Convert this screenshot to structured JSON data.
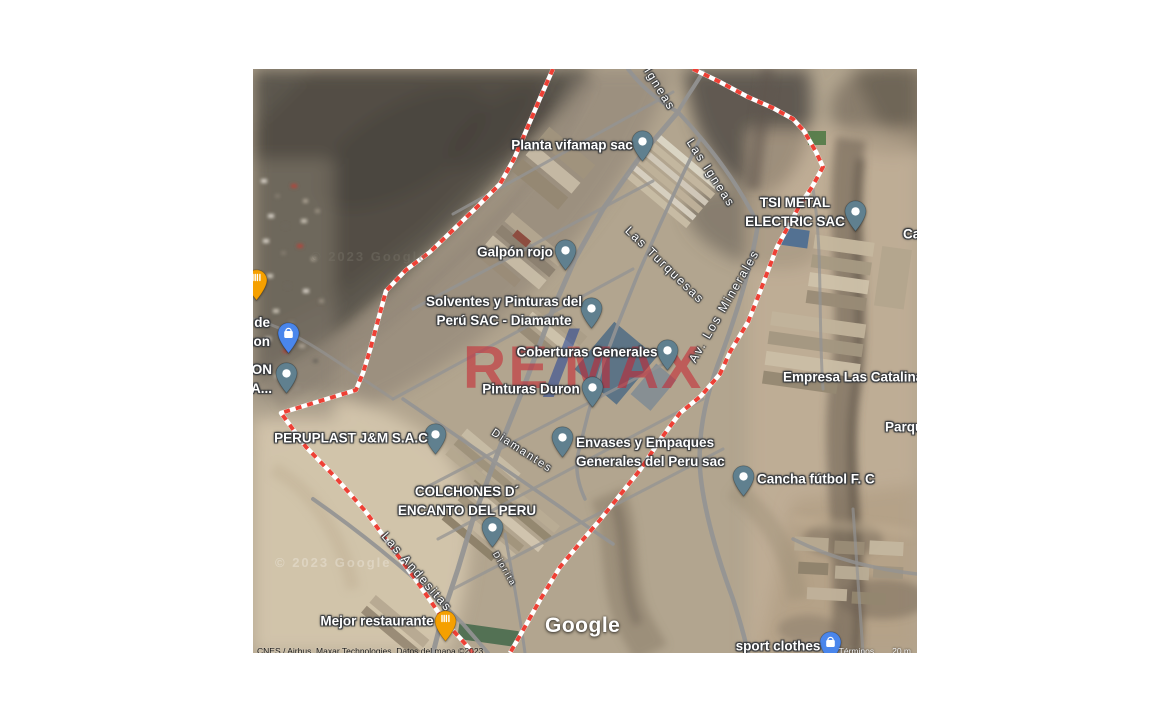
{
  "map": {
    "left": 253,
    "top": 69,
    "width": 664,
    "height": 584
  },
  "branding": {
    "google_logo": "Google",
    "watermark": {
      "re": "RE",
      "slash": "/",
      "max": "MAX",
      "red": "#C8222E",
      "blue": "#1F4096"
    },
    "ghost_credit": "© 2023 Google"
  },
  "attribution": {
    "imagery": "CNES / Airbus, Maxar Technologies, Datos del mapa ©2023",
    "terms": "Términos",
    "scale": "20 m"
  },
  "colors": {
    "pin_poi": "#60808F",
    "pin_shop": "#4A86EC",
    "pin_food": "#F5A000",
    "boundary_red": "#EE4035",
    "road": "#949494",
    "label_text": "#FFFFFF"
  },
  "labels": [
    {
      "name": "label-planta-vifamap",
      "lines": [
        "Planta vifamap sac"
      ],
      "x": 319,
      "y": 76,
      "align": "center"
    },
    {
      "name": "label-galpon-rojo",
      "lines": [
        "Galpón rojo"
      ],
      "x": 262,
      "y": 183,
      "align": "center"
    },
    {
      "name": "label-solventes-pinturas",
      "lines": [
        "Solventes y Pinturas del",
        "Perú SAC - Diamante"
      ],
      "x": 251,
      "y": 242,
      "align": "center"
    },
    {
      "name": "label-coberturas-generales",
      "lines": [
        "Coberturas Generales"
      ],
      "x": 334,
      "y": 283,
      "align": "center"
    },
    {
      "name": "label-pinturas-duron",
      "lines": [
        "Pinturas Duron"
      ],
      "x": 278,
      "y": 320,
      "align": "center"
    },
    {
      "name": "label-tsi-metal-electric",
      "lines": [
        "TSI METAL",
        "ELECTRIC SAC"
      ],
      "x": 542,
      "y": 143,
      "align": "center"
    },
    {
      "name": "label-empresa-las-catalina",
      "lines": [
        "Empresa Las Catalina"
      ],
      "x": 530,
      "y": 308,
      "align": "left"
    },
    {
      "name": "label-parque",
      "lines": [
        "Parqu"
      ],
      "x": 632,
      "y": 358,
      "align": "left"
    },
    {
      "name": "label-cancha-futbol",
      "lines": [
        "Cancha fútbol F. C"
      ],
      "x": 504,
      "y": 410,
      "align": "left"
    },
    {
      "name": "label-peruplast",
      "lines": [
        "PERUPLAST J&M S.A.C"
      ],
      "x": 98,
      "y": 369,
      "align": "center"
    },
    {
      "name": "label-envases-empaques",
      "lines": [
        "Envases y Empaques",
        "Generales del Peru sac"
      ],
      "x": 323,
      "y": 383,
      "align": "left"
    },
    {
      "name": "label-colchones-encanto",
      "lines": [
        "COLCHONES D´",
        "ENCANTO DEL PERU"
      ],
      "x": 214,
      "y": 432,
      "align": "center"
    },
    {
      "name": "label-mejor-restaurante",
      "lines": [
        "Mejor restaurante"
      ],
      "x": 124,
      "y": 552,
      "align": "center"
    },
    {
      "name": "label-sport-clothes",
      "lines": [
        "sport clothes"
      ],
      "x": 525,
      "y": 577,
      "align": "center"
    },
    {
      "name": "label-fragment-r-de",
      "lines": [
        "r de",
        "son"
      ],
      "x": 17,
      "y": 263,
      "align": "right"
    },
    {
      "name": "label-fragment-ion-da",
      "lines": [
        "ION",
        "DA..."
      ],
      "x": 19,
      "y": 310,
      "align": "right"
    },
    {
      "name": "label-fragment-ca",
      "lines": [
        "Ca"
      ],
      "x": 650,
      "y": 165,
      "align": "left"
    }
  ],
  "streets": [
    {
      "name": "street-las-igneas-top",
      "label": "Igneas",
      "x": 407,
      "y": 20,
      "angle": 58,
      "size": 12
    },
    {
      "name": "street-las-igneas",
      "label": "Las Igneas",
      "x": 458,
      "y": 104,
      "angle": 57,
      "size": 12
    },
    {
      "name": "street-las-turquesas",
      "label": "Las Turquesas",
      "x": 412,
      "y": 196,
      "angle": 44,
      "size": 12
    },
    {
      "name": "street-av-los-minerales",
      "label": "Av. Los Minerales",
      "x": 471,
      "y": 237,
      "angle": -60,
      "size": 12
    },
    {
      "name": "street-diamantes",
      "label": "Diamantes",
      "x": 269,
      "y": 382,
      "angle": 33,
      "size": 11
    },
    {
      "name": "street-las-andesitas",
      "label": "Las Andesitas",
      "x": 164,
      "y": 503,
      "angle": 49,
      "size": 12
    },
    {
      "name": "street-diorita",
      "label": "Diorita",
      "x": 252,
      "y": 500,
      "angle": 60,
      "size": 8.5
    }
  ],
  "pins": [
    {
      "name": "pin-planta-vifamap",
      "type": "poi",
      "x": 389,
      "y": 72
    },
    {
      "name": "pin-galpon-rojo",
      "type": "poi",
      "x": 312,
      "y": 181
    },
    {
      "name": "pin-solventes",
      "type": "poi",
      "x": 338,
      "y": 239
    },
    {
      "name": "pin-coberturas",
      "type": "poi",
      "x": 414,
      "y": 281
    },
    {
      "name": "pin-pinturas-duron",
      "type": "poi",
      "x": 339,
      "y": 318
    },
    {
      "name": "pin-tsi-metal",
      "type": "poi",
      "x": 602,
      "y": 142
    },
    {
      "name": "pin-peruplast",
      "type": "poi",
      "x": 182,
      "y": 365
    },
    {
      "name": "pin-envases",
      "type": "poi",
      "x": 309,
      "y": 368
    },
    {
      "name": "pin-colchones",
      "type": "poi",
      "x": 239,
      "y": 458
    },
    {
      "name": "pin-cancha-futbol",
      "type": "poi",
      "x": 490,
      "y": 407
    },
    {
      "name": "pin-left-poi",
      "type": "poi",
      "x": 33,
      "y": 304
    },
    {
      "name": "pin-shopping-left",
      "type": "shop",
      "x": 35,
      "y": 264
    },
    {
      "name": "pin-shopping-bottom",
      "type": "shop",
      "x": 577,
      "y": 573
    },
    {
      "name": "pin-restaurant-left",
      "type": "food",
      "x": 3,
      "y": 211
    },
    {
      "name": "pin-restaurant-bottom",
      "type": "food",
      "x": 192,
      "y": 552
    }
  ]
}
